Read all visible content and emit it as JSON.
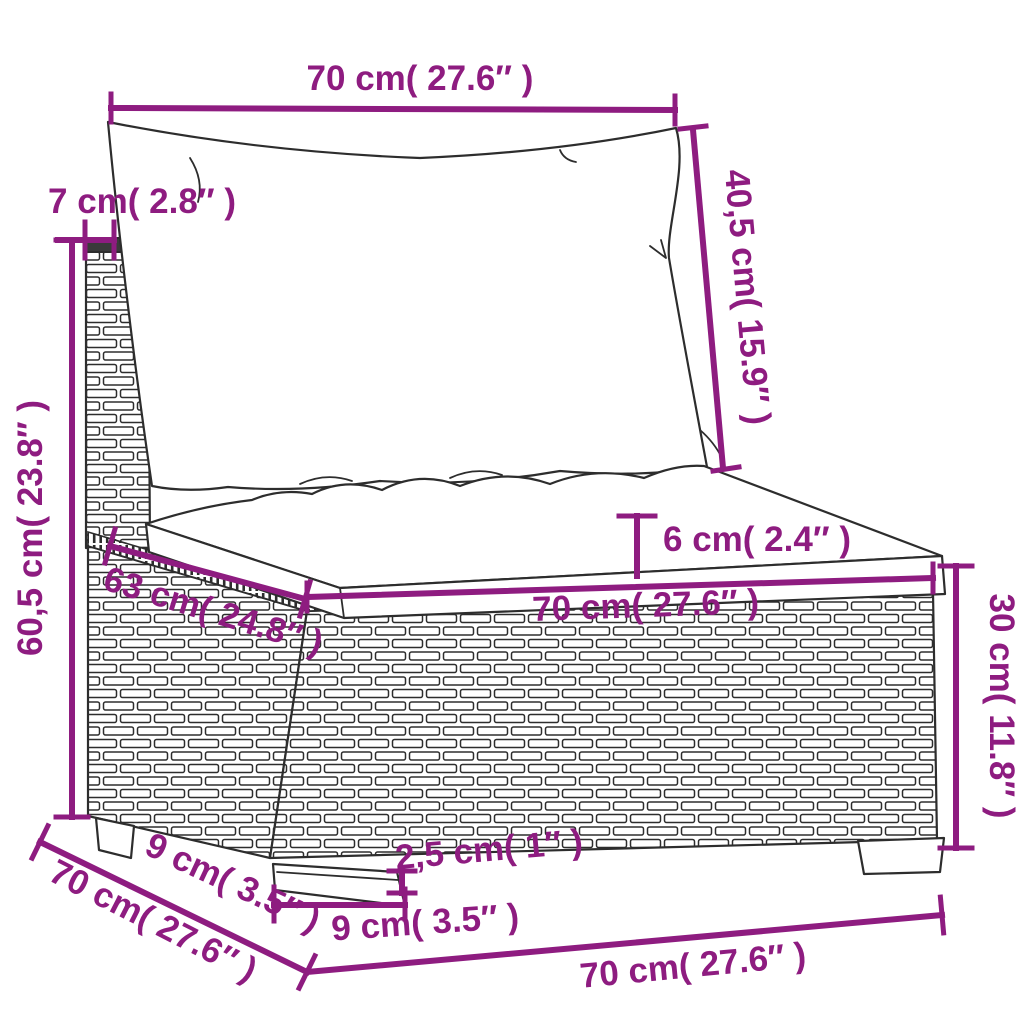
{
  "diagram": {
    "colors": {
      "dimension": "#8e1c80",
      "line_art": "#2d2d2d",
      "background": "#ffffff"
    },
    "dimensions": {
      "back_cushion_width": {
        "label": "70 cm( 27.6″ )"
      },
      "back_panel_thickness": {
        "label": "7 cm( 2.8″ )"
      },
      "back_cushion_height": {
        "label": "40,5 cm( 15.9″ )"
      },
      "total_height": {
        "label": "60,5 cm( 23.8″ )"
      },
      "seat_cushion_thickness": {
        "label": "6 cm( 2.4″ )"
      },
      "seat_width": {
        "label": "70 cm( 27.6″ )"
      },
      "seat_depth": {
        "label": "63 cm( 24.8″ )"
      },
      "base_height": {
        "label": "30 cm( 11.8″ )"
      },
      "leg_height": {
        "label": "2,5 cm( 1″ )"
      },
      "leg_width": {
        "label": "9 cm( 3.5″ )"
      },
      "leg_inset_depth": {
        "label": "9 cm( 3.5″ )"
      },
      "base_depth": {
        "label": "70 cm( 27.6″ )"
      },
      "base_width": {
        "label": "70 cm( 27.6″ )"
      }
    }
  }
}
